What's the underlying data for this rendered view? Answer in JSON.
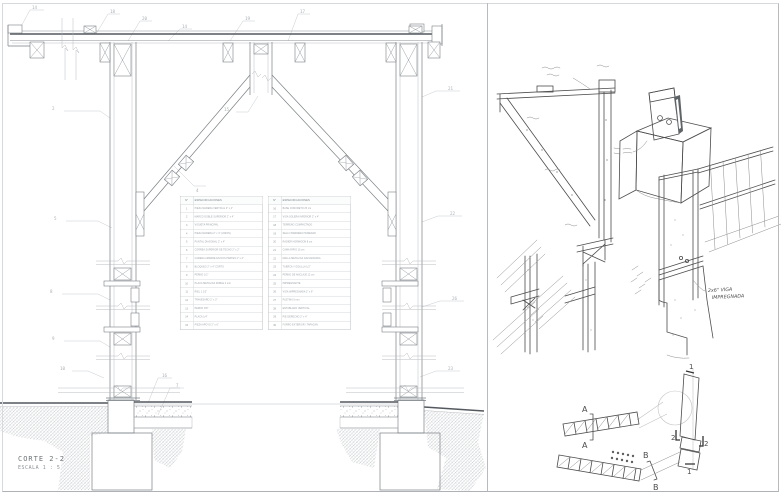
{
  "title_block": {
    "title": "CORTE 2-2",
    "scale": "ESCALA 1 : 5"
  },
  "spec_tables": [
    {
      "number_header": "N°",
      "spec_header": "ESPECIFICACIONES",
      "rows": [
        {
          "no": "1",
          "text": "PIEZA MADERA VERTICAL 2\" x 4\""
        },
        {
          "no": "2",
          "text": "MARCO DOBLE SUPERIOR 2\" x 4\""
        },
        {
          "no": "3",
          "text": "VIGUETA PRINCIPAL"
        },
        {
          "no": "4",
          "text": "PIEZA MADERA 2\" x 4\" (UNION)"
        },
        {
          "no": "5",
          "text": "PUNTAL DIAGONAL 2\" x 4\""
        },
        {
          "no": "6",
          "text": "CORREA SUPERIOR DE TECHO 2\" x 2\""
        },
        {
          "no": "7",
          "text": "CADENA AMARRE EN DOS PARTES 2\" x 4\""
        },
        {
          "no": "8",
          "text": "BLOQUEO 2\" x 4\" CORTO"
        },
        {
          "no": "9",
          "text": "PERNO 1/2\""
        },
        {
          "no": "10",
          "text": "PLACA METALICA DOBLE 4 mm"
        },
        {
          "no": "11",
          "text": "RIEL 1 1/2\""
        },
        {
          "no": "12",
          "text": "TRAVESAÑO 2\" x 3\""
        },
        {
          "no": "13",
          "text": "PERNO 3/8\""
        },
        {
          "no": "14",
          "text": "PLACA 1/4\""
        },
        {
          "no": "15",
          "text": "PIEZA APOYO 2\" x 6\""
        }
      ]
    },
    {
      "number_header": "N°",
      "spec_header": "ESPECIFICACIONES",
      "rows": [
        {
          "no": "16",
          "text": "BASE CONCRETO 25 cm"
        },
        {
          "no": "17",
          "text": "VIGA SOLERA INFERIOR 2\" x 4\""
        },
        {
          "no": "18",
          "text": "TERRENO COMPACTADO"
        },
        {
          "no": "19",
          "text": "SELLO BARRERA HUMEDAD"
        },
        {
          "no": "20",
          "text": "RADIER HORMIGON 8 cm"
        },
        {
          "no": "21",
          "text": "CAMA RIPIO 10 cm"
        },
        {
          "no": "22",
          "text": "MALLA METALICA GALVANIZADA"
        },
        {
          "no": "23",
          "text": "TUERCA Y GOLILLA 1/2\""
        },
        {
          "no": "24",
          "text": "PERNO DE ANCLAJE 12 cm"
        },
        {
          "no": "25",
          "text": "IMPREGNANTE"
        },
        {
          "no": "26",
          "text": "VIGA IMPREGNADA 2\" x 6\""
        },
        {
          "no": "27",
          "text": "PLETINA 5 mm"
        },
        {
          "no": "28",
          "text": "ENTABLADO VERTICAL"
        },
        {
          "no": "29",
          "text": "PIE DERECHO 2\" x 4\""
        },
        {
          "no": "30",
          "text": "FORRO EXTERIOR / TAPACAN"
        }
      ]
    }
  ],
  "callouts": [
    {
      "n": "14",
      "x": 32,
      "y": 5
    },
    {
      "n": "18",
      "x": 110,
      "y": 9
    },
    {
      "n": "20",
      "x": 142,
      "y": 16
    },
    {
      "n": "14",
      "x": 182,
      "y": 24
    },
    {
      "n": "19",
      "x": 245,
      "y": 16
    },
    {
      "n": "17",
      "x": 300,
      "y": 9
    },
    {
      "n": "2",
      "x": 52,
      "y": 106
    },
    {
      "n": "21",
      "x": 448,
      "y": 86
    },
    {
      "n": "4",
      "x": 196,
      "y": 188
    },
    {
      "n": "15",
      "x": 224,
      "y": 107
    },
    {
      "n": "5",
      "x": 54,
      "y": 216
    },
    {
      "n": "22",
      "x": 450,
      "y": 211
    },
    {
      "n": "8",
      "x": 50,
      "y": 289
    },
    {
      "n": "26",
      "x": 452,
      "y": 296
    },
    {
      "n": "9",
      "x": 52,
      "y": 336
    },
    {
      "n": "10",
      "x": 60,
      "y": 366
    },
    {
      "n": "16",
      "x": 162,
      "y": 373
    },
    {
      "n": "7",
      "x": 176,
      "y": 383
    },
    {
      "n": "23",
      "x": 448,
      "y": 366
    }
  ],
  "sketch_annotations": {
    "sill_size": "2x6\" VIGA",
    "sill_material": "IMPREGNADA"
  },
  "plan_markers": {
    "a_top": "A",
    "a_bottom": "A",
    "b_top": "B",
    "b_bottom": "B",
    "sec1_top": "1",
    "sec2_left": "2",
    "sec2_right": "2",
    "sec1_bottom": "1"
  },
  "colors": {
    "cad_line": "#7a8085",
    "cad_dark": "#54595e",
    "hatch": "#b3b7bb",
    "sketch_line": "#4c4c4c",
    "callout": "#aab0b5",
    "border": "#b7bbbf"
  }
}
